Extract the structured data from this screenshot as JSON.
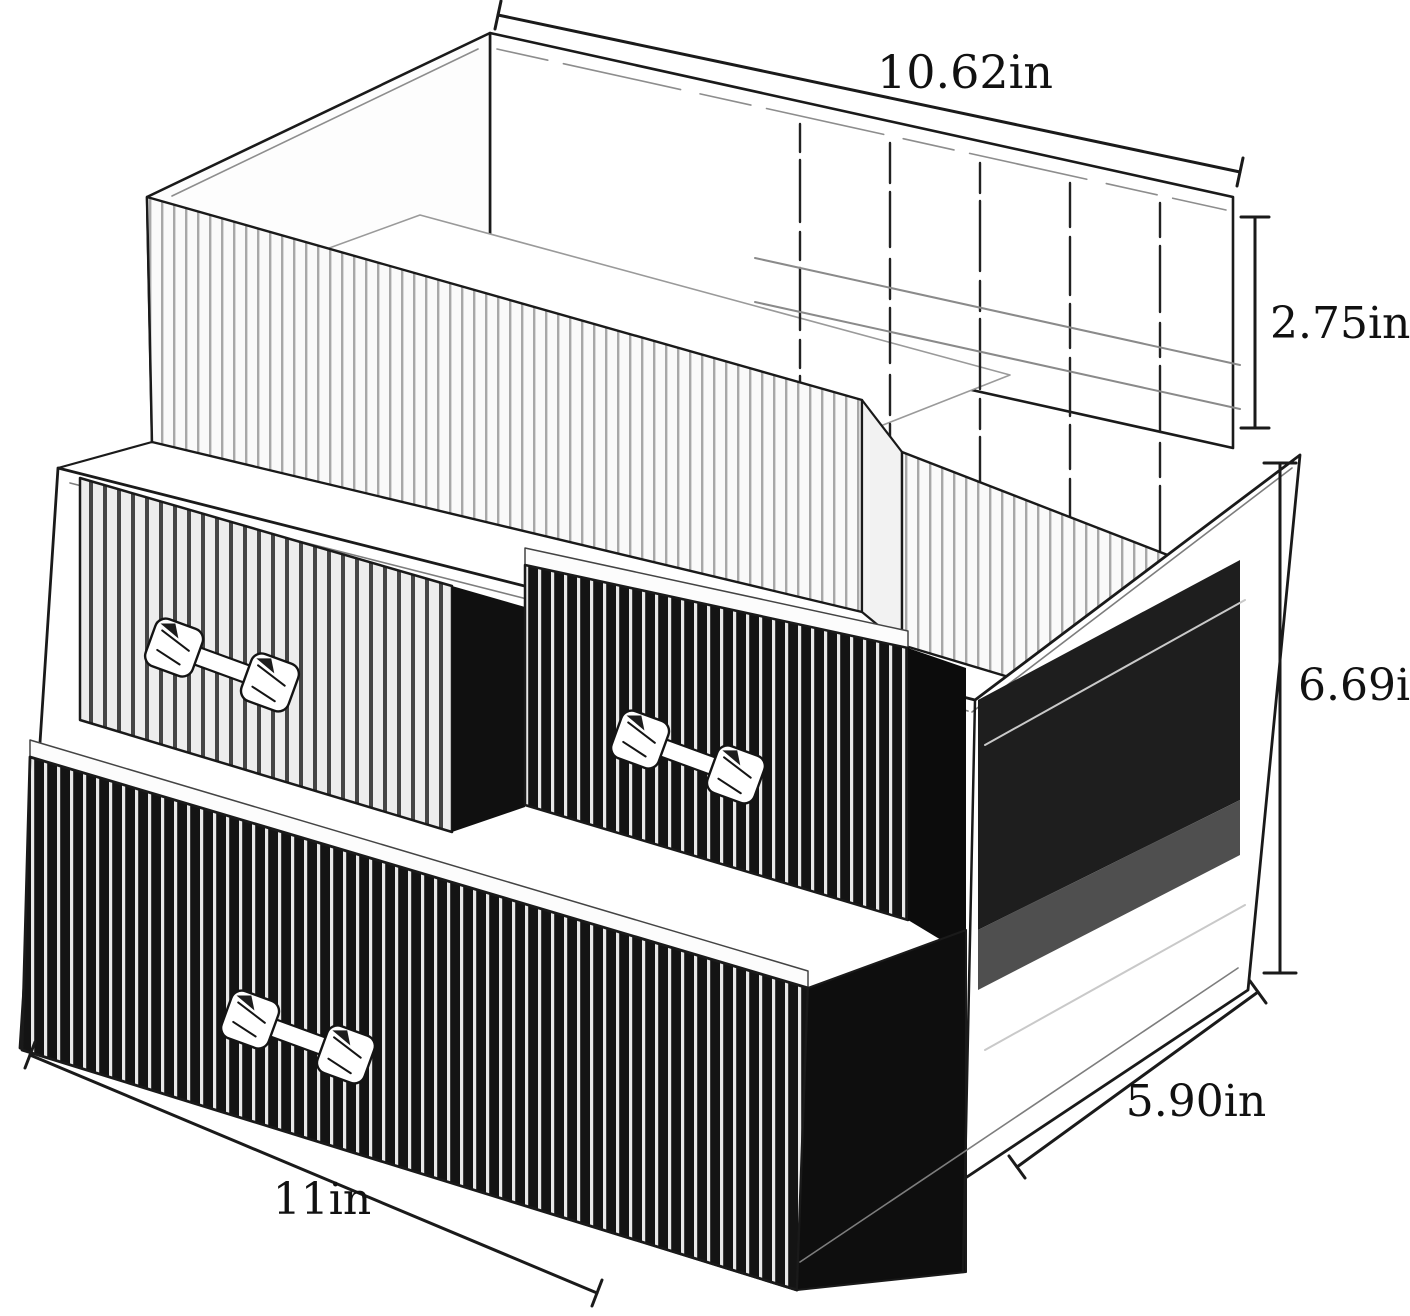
{
  "title": "Clear acrylic cosmetic organizer dimension diagram",
  "dimensions": {
    "top_width": "10.62in",
    "top_section_height": "2.75in",
    "drawer_section_height": "6.69in",
    "depth": "5.90in",
    "bottom_width": "11in"
  },
  "colors": {
    "line": "#1a1a1a",
    "dark_cavity": "#101010",
    "panel_shadow": "#1e1e1e",
    "background": "#ffffff"
  }
}
